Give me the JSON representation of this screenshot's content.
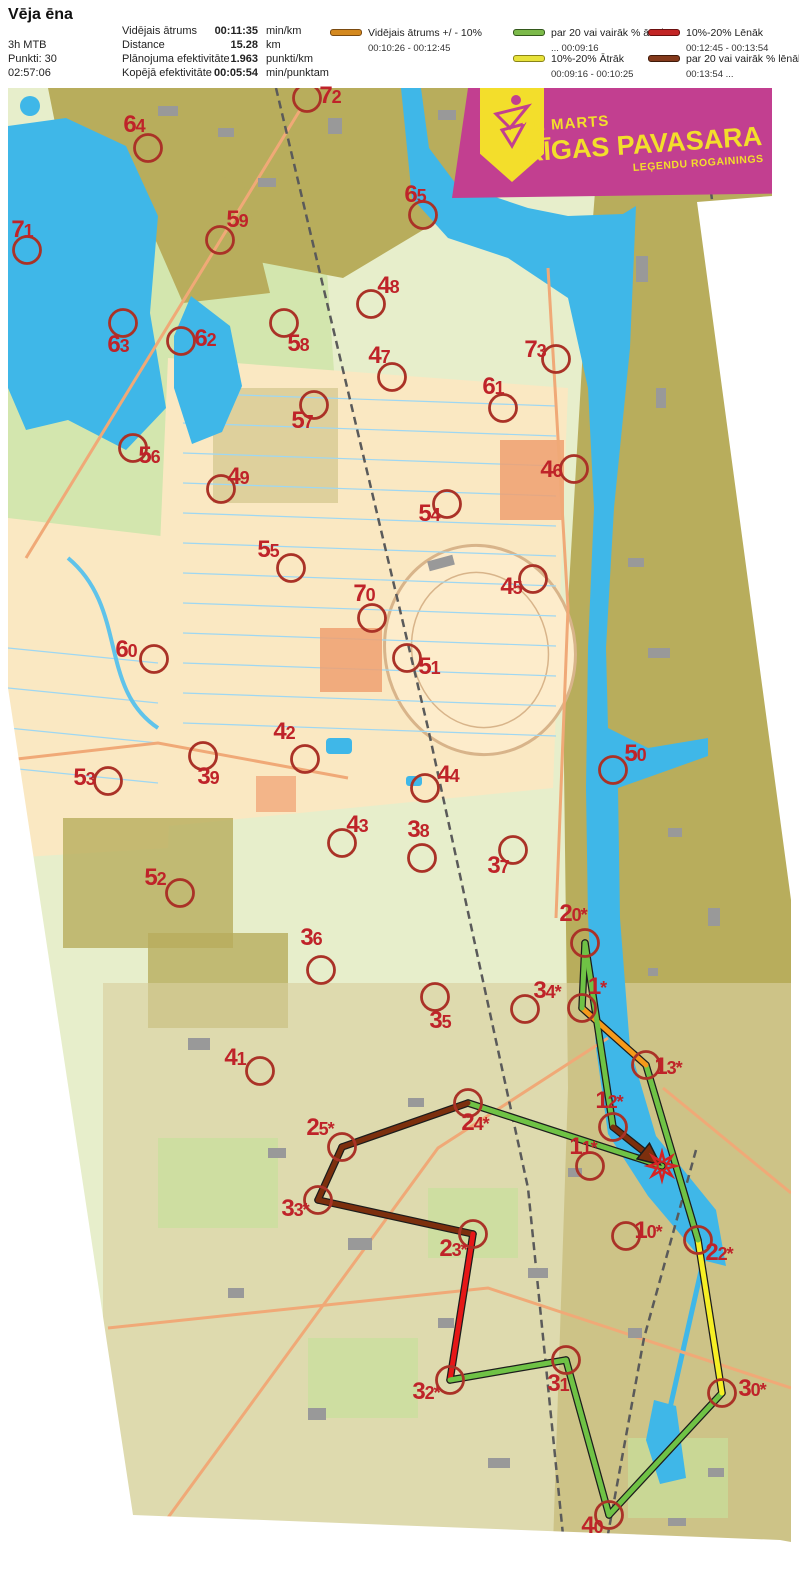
{
  "header": {
    "title": "Vēja ēna",
    "class_label": "3h MTB",
    "points_label": "Punkti: 30",
    "total_time": "02:57:06",
    "stats": [
      {
        "label": "Vidējais ātrums",
        "value": "00:11:35",
        "unit": "min/km"
      },
      {
        "label": "Distance",
        "value": "15.28",
        "unit": "km"
      },
      {
        "label": "Plānojuma efektivitāte",
        "value": "1.963",
        "unit": "punkti/km"
      },
      {
        "label": "Kopējā efektivitāte",
        "value": "00:05:54",
        "unit": "min/punktam"
      }
    ],
    "legend": [
      {
        "label": "Vidējais ātrums +/ - 10%",
        "range": "00:10:26  -  00:12:45",
        "color": "#d4891f",
        "border": "#7a4a10"
      },
      {
        "label": "par 20 vai vairāk % ātrāk",
        "range": "...  00:09:16",
        "color": "#7cba4a",
        "border": "#33581c"
      },
      {
        "label": "10%-20% Ātrāk",
        "range": "00:09:16  -  00:10:25",
        "color": "#e8e23a",
        "border": "#8a8418"
      },
      {
        "label": "10%-20% Lēnāk",
        "range": "00:12:45  -  00:13:54",
        "color": "#c22525",
        "border": "#6b0f0f"
      },
      {
        "label": "par 20 vai vairāk % lēnāk",
        "range": "00:13:54  ...",
        "color": "#83391b",
        "border": "#3f1a09"
      }
    ]
  },
  "banner": {
    "date": "21. MARTS",
    "title": "RĪGAS PAVASARA",
    "subtitle": "LEĢENDU ROGAININGS"
  },
  "map": {
    "finish": {
      "id": "S",
      "x": 654,
      "y": 1078
    },
    "controls": [
      {
        "id": "72",
        "x": 299,
        "y": 10,
        "lx": 322,
        "ly": 9
      },
      {
        "id": "64",
        "x": 140,
        "y": 60,
        "lx": 126,
        "ly": 38
      },
      {
        "id": "71",
        "x": 19,
        "y": 162,
        "lx": 14,
        "ly": 143
      },
      {
        "id": "59",
        "x": 212,
        "y": 152,
        "lx": 229,
        "ly": 133
      },
      {
        "id": "65",
        "x": 415,
        "y": 127,
        "lx": 407,
        "ly": 108
      },
      {
        "id": "63",
        "x": 115,
        "y": 235,
        "lx": 110,
        "ly": 258
      },
      {
        "id": "62",
        "x": 173,
        "y": 253,
        "lx": 197,
        "ly": 252
      },
      {
        "id": "58",
        "x": 276,
        "y": 235,
        "lx": 290,
        "ly": 257
      },
      {
        "id": "48",
        "x": 363,
        "y": 216,
        "lx": 380,
        "ly": 199
      },
      {
        "id": "47",
        "x": 384,
        "y": 289,
        "lx": 371,
        "ly": 269
      },
      {
        "id": "73",
        "x": 548,
        "y": 271,
        "lx": 527,
        "ly": 263
      },
      {
        "id": "61",
        "x": 495,
        "y": 320,
        "lx": 485,
        "ly": 300
      },
      {
        "id": "46",
        "x": 566,
        "y": 381,
        "lx": 543,
        "ly": 383
      },
      {
        "id": "57",
        "x": 306,
        "y": 317,
        "lx": 294,
        "ly": 334
      },
      {
        "id": "56",
        "x": 125,
        "y": 360,
        "lx": 141,
        "ly": 369
      },
      {
        "id": "49",
        "x": 213,
        "y": 401,
        "lx": 230,
        "ly": 390
      },
      {
        "id": "54",
        "x": 439,
        "y": 416,
        "lx": 421,
        "ly": 427
      },
      {
        "id": "55",
        "x": 283,
        "y": 480,
        "lx": 260,
        "ly": 463
      },
      {
        "id": "45",
        "x": 525,
        "y": 491,
        "lx": 503,
        "ly": 500
      },
      {
        "id": "70",
        "x": 364,
        "y": 530,
        "lx": 356,
        "ly": 507
      },
      {
        "id": "51",
        "x": 399,
        "y": 570,
        "lx": 421,
        "ly": 580
      },
      {
        "id": "60",
        "x": 146,
        "y": 571,
        "lx": 118,
        "ly": 563
      },
      {
        "id": "50",
        "x": 605,
        "y": 682,
        "lx": 627,
        "ly": 667
      },
      {
        "id": "53",
        "x": 100,
        "y": 693,
        "lx": 76,
        "ly": 691
      },
      {
        "id": "42",
        "x": 297,
        "y": 671,
        "lx": 276,
        "ly": 645
      },
      {
        "id": "39",
        "x": 195,
        "y": 668,
        "lx": 200,
        "ly": 690
      },
      {
        "id": "44",
        "x": 417,
        "y": 700,
        "lx": 440,
        "ly": 688
      },
      {
        "id": "43",
        "x": 334,
        "y": 755,
        "lx": 349,
        "ly": 738
      },
      {
        "id": "38",
        "x": 414,
        "y": 770,
        "lx": 410,
        "ly": 743
      },
      {
        "id": "37",
        "x": 505,
        "y": 762,
        "lx": 490,
        "ly": 779
      },
      {
        "id": "52",
        "x": 172,
        "y": 805,
        "lx": 147,
        "ly": 791
      },
      {
        "id": "36",
        "x": 313,
        "y": 882,
        "lx": 303,
        "ly": 851
      },
      {
        "id": "35",
        "x": 427,
        "y": 909,
        "lx": 432,
        "ly": 934
      },
      {
        "id": "41",
        "x": 252,
        "y": 983,
        "lx": 227,
        "ly": 971
      },
      {
        "id": "34*",
        "x": 517,
        "y": 921,
        "lx": 539,
        "ly": 904
      },
      {
        "id": "20*",
        "x": 577,
        "y": 855,
        "lx": 565,
        "ly": 827
      },
      {
        "id": "1*",
        "x": 574,
        "y": 920,
        "lx": 589,
        "ly": 900
      },
      {
        "id": "13*",
        "x": 638,
        "y": 977,
        "lx": 660,
        "ly": 980
      },
      {
        "id": "12*",
        "x": 605,
        "y": 1039,
        "lx": 601,
        "ly": 1014
      },
      {
        "id": "11*",
        "x": 582,
        "y": 1078,
        "lx": 575,
        "ly": 1060
      },
      {
        "id": "24*",
        "x": 460,
        "y": 1015,
        "lx": 467,
        "ly": 1036
      },
      {
        "id": "25*",
        "x": 334,
        "y": 1059,
        "lx": 312,
        "ly": 1041
      },
      {
        "id": "33*",
        "x": 310,
        "y": 1112,
        "lx": 287,
        "ly": 1122
      },
      {
        "id": "23*",
        "x": 465,
        "y": 1146,
        "lx": 445,
        "ly": 1162
      },
      {
        "id": "10*",
        "x": 618,
        "y": 1148,
        "lx": 640,
        "ly": 1144
      },
      {
        "id": "22*",
        "x": 690,
        "y": 1152,
        "lx": 711,
        "ly": 1166
      },
      {
        "id": "32*",
        "x": 442,
        "y": 1292,
        "lx": 418,
        "ly": 1305
      },
      {
        "id": "31",
        "x": 558,
        "y": 1272,
        "lx": 550,
        "ly": 1297
      },
      {
        "id": "30*",
        "x": 714,
        "y": 1305,
        "lx": 744,
        "ly": 1302
      },
      {
        "id": "40",
        "x": 601,
        "y": 1427,
        "lx": 584,
        "ly": 1439
      }
    ],
    "route_colors": {
      "green": "#6fc245",
      "orange": "#f59a1b",
      "yellow": "#f6ef25",
      "red": "#e61717",
      "brown": "#7c2f0d",
      "outline": "#1c1c1c"
    },
    "circle_color": "#aa3227",
    "finish_color": "#d42424",
    "route_legs": [
      {
        "from": "S",
        "to": "24*",
        "color": "green"
      },
      {
        "from": "24*",
        "to": "25*",
        "color": "brown"
      },
      {
        "from": "25*",
        "to": "33*",
        "color": "brown"
      },
      {
        "from": "33*",
        "to": "23*",
        "color": "brown"
      },
      {
        "from": "23*",
        "to": "32*",
        "color": "red"
      },
      {
        "from": "32*",
        "to": "31",
        "color": "green"
      },
      {
        "from": "31",
        "to": "40",
        "color": "green"
      },
      {
        "from": "40",
        "to": "30*",
        "color": "green"
      },
      {
        "from": "30*",
        "to": "22*",
        "color": "yellow"
      },
      {
        "from": "22*",
        "to": "13*",
        "color": "green"
      },
      {
        "from": "13*",
        "to": "1*",
        "color": "orange"
      },
      {
        "from": "1*",
        "to": "20*",
        "color": "green"
      },
      {
        "from": "20*",
        "to": "12*",
        "color": "green"
      },
      {
        "from": "12*",
        "to": "S",
        "color": "brown",
        "arrow": true
      }
    ]
  }
}
